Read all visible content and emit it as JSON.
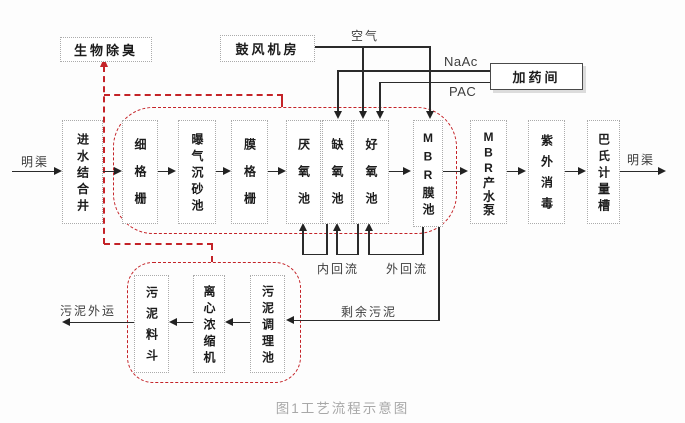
{
  "figure": {
    "caption": "图1工艺流程示意图"
  },
  "top_boxes": {
    "bio_deodorization": "生物除臭",
    "blower_room": "鼓风机房",
    "dosing_room": "加药间"
  },
  "main_boxes": [
    {
      "label": "进水结合井"
    },
    {
      "label": "细格栅"
    },
    {
      "label": "曝气沉砂池"
    },
    {
      "label": "膜格栅"
    },
    {
      "label": "厌氧池"
    },
    {
      "label": "缺氧池"
    },
    {
      "label": "好氧池"
    },
    {
      "label": "MBR膜池"
    },
    {
      "label": "MBR产水泵"
    },
    {
      "label": "紫外消毒"
    },
    {
      "label": "巴氏计量槽"
    }
  ],
  "sludge_boxes": [
    {
      "label": "污泥料斗"
    },
    {
      "label": "离心浓缩机"
    },
    {
      "label": "污泥调理池"
    }
  ],
  "labels": {
    "open_channel_in": "明渠",
    "open_channel_out": "明渠",
    "air": "空气",
    "naac": "NaAc",
    "pac": "PAC",
    "internal_recycle": "内回流",
    "external_recycle": "外回流",
    "excess_sludge": "剩余污泥",
    "sludge_out": "污泥外运"
  },
  "colors": {
    "red_enclosure": "#c42328",
    "line": "#2b2b2b",
    "box_border": "#ababab",
    "caption_gray": "#a8a8a8"
  }
}
